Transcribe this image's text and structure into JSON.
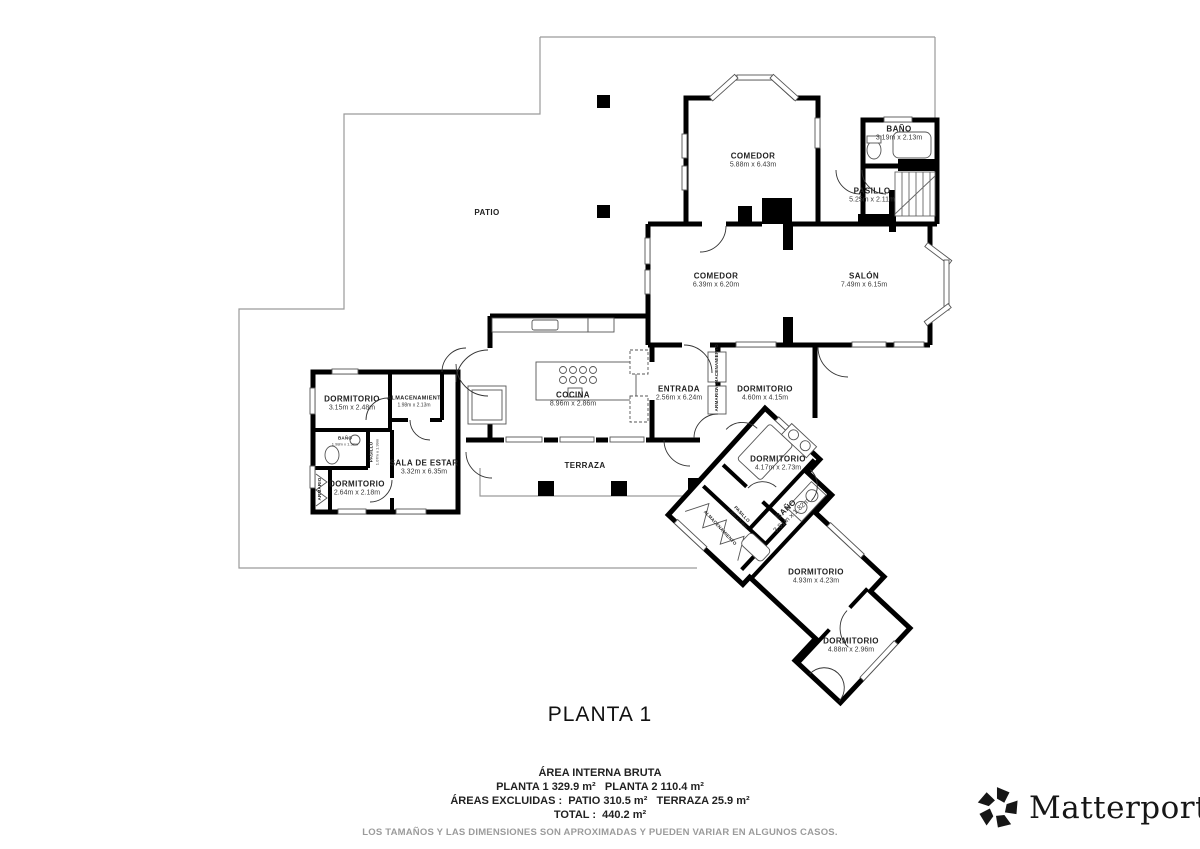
{
  "title": "PLANTA 1",
  "summary": {
    "line1": "ÁREA INTERNA BRUTA",
    "line2": "PLANTA 1 329.9 m²   PLANTA 2 110.4 m²",
    "line3": "ÁREAS EXCLUIDAS :  PATIO 310.5 m²   TERRAZA 25.9 m²",
    "line4": "TOTAL :  440.2 m²",
    "disclaimer": "LOS TAMAÑOS Y LAS DIMENSIONES SON APROXIMADAS Y PUEDEN VARIAR EN ALGUNOS CASOS."
  },
  "brand": {
    "name": "Matterport",
    "reg": "®",
    "icon": "matterport-pinwheel-icon"
  },
  "colors": {
    "wall": "#000000",
    "outline": "#9a9a9a",
    "fixture": "#555555",
    "text": "#222222"
  },
  "rooms": [
    {
      "name": "PATIO",
      "dims": "",
      "x": 487,
      "y": 213,
      "rot": 0,
      "size": "md"
    },
    {
      "name": "COMEDOR",
      "dims": "5.88m x 6.43m",
      "x": 753,
      "y": 161,
      "rot": 0,
      "size": "md"
    },
    {
      "name": "BAÑO",
      "dims": "3.19m x 2.13m",
      "x": 899,
      "y": 134,
      "rot": 0,
      "size": "md"
    },
    {
      "name": "PASILLO",
      "dims": "5.25m x 2.11m",
      "x": 872,
      "y": 196,
      "rot": 0,
      "size": "md"
    },
    {
      "name": "COMEDOR",
      "dims": "6.39m x 6.20m",
      "x": 716,
      "y": 281,
      "rot": 0,
      "size": "md"
    },
    {
      "name": "SALÓN",
      "dims": "7.49m x 6.15m",
      "x": 864,
      "y": 281,
      "rot": 0,
      "size": "md"
    },
    {
      "name": "COCINA",
      "dims": "8.96m x 2.86m",
      "x": 573,
      "y": 400,
      "rot": 0,
      "size": "md"
    },
    {
      "name": "ENTRADA",
      "dims": "2.56m x 6.24m",
      "x": 679,
      "y": 394,
      "rot": 0,
      "size": "md"
    },
    {
      "name": "DORMITORIO",
      "dims": "4.60m x 4.15m",
      "x": 765,
      "y": 394,
      "rot": 0,
      "size": "md"
    },
    {
      "name": "ALMACENAMIENTO",
      "dims": "",
      "x": 717,
      "y": 367,
      "rot": -90,
      "size": "xs"
    },
    {
      "name": "ARMARIO",
      "dims": "",
      "x": 717,
      "y": 400,
      "rot": -90,
      "size": "xs"
    },
    {
      "name": "DORMITORIO",
      "dims": "3.15m x 2.48m",
      "x": 352,
      "y": 404,
      "rot": 0,
      "size": "md"
    },
    {
      "name": "ALMACENAMIENT",
      "dims": "1.98m x 2.13m",
      "x": 414,
      "y": 402,
      "rot": 0,
      "size": "sm"
    },
    {
      "name": "BAÑO",
      "dims": "1.98m x 1.38m",
      "x": 345,
      "y": 441,
      "rot": 0,
      "size": "xs"
    },
    {
      "name": "PASILLO",
      "dims": "1.07m x 1.99m",
      "x": 374,
      "y": 452,
      "rot": -90,
      "size": "xs"
    },
    {
      "name": "SALA DE ESTAR",
      "dims": "3.32m x 6.35m",
      "x": 424,
      "y": 468,
      "rot": 0,
      "size": "md"
    },
    {
      "name": "DORMITORIO",
      "dims": "2.64m x 2.18m",
      "x": 357,
      "y": 489,
      "rot": 0,
      "size": "md"
    },
    {
      "name": "ARMARIO",
      "dims": "",
      "x": 320,
      "y": 489,
      "rot": -90,
      "size": "xs"
    },
    {
      "name": "TERRAZA",
      "dims": "",
      "x": 585,
      "y": 466,
      "rot": 0,
      "size": "md"
    },
    {
      "name": "DORMITORIO",
      "dims": "4.17m x 2.73m",
      "x": 778,
      "y": 464,
      "rot": 0,
      "size": "md"
    },
    {
      "name": "BAÑO",
      "dims": "3.81m x 1.82m",
      "x": 789,
      "y": 513,
      "rot": -43,
      "size": "md"
    },
    {
      "name": "PASILLO",
      "dims": "1.10m x 3.96m",
      "x": 740,
      "y": 516,
      "rot": 47,
      "size": "xs"
    },
    {
      "name": "ALMACENAMIENTO",
      "dims": "",
      "x": 720,
      "y": 528,
      "rot": 47,
      "size": "xs"
    },
    {
      "name": "DORMITORIO",
      "dims": "4.93m x 4.23m",
      "x": 816,
      "y": 577,
      "rot": 0,
      "size": "md"
    },
    {
      "name": "DORMITORIO",
      "dims": "4.88m x 2.96m",
      "x": 851,
      "y": 646,
      "rot": 0,
      "size": "md"
    }
  ]
}
